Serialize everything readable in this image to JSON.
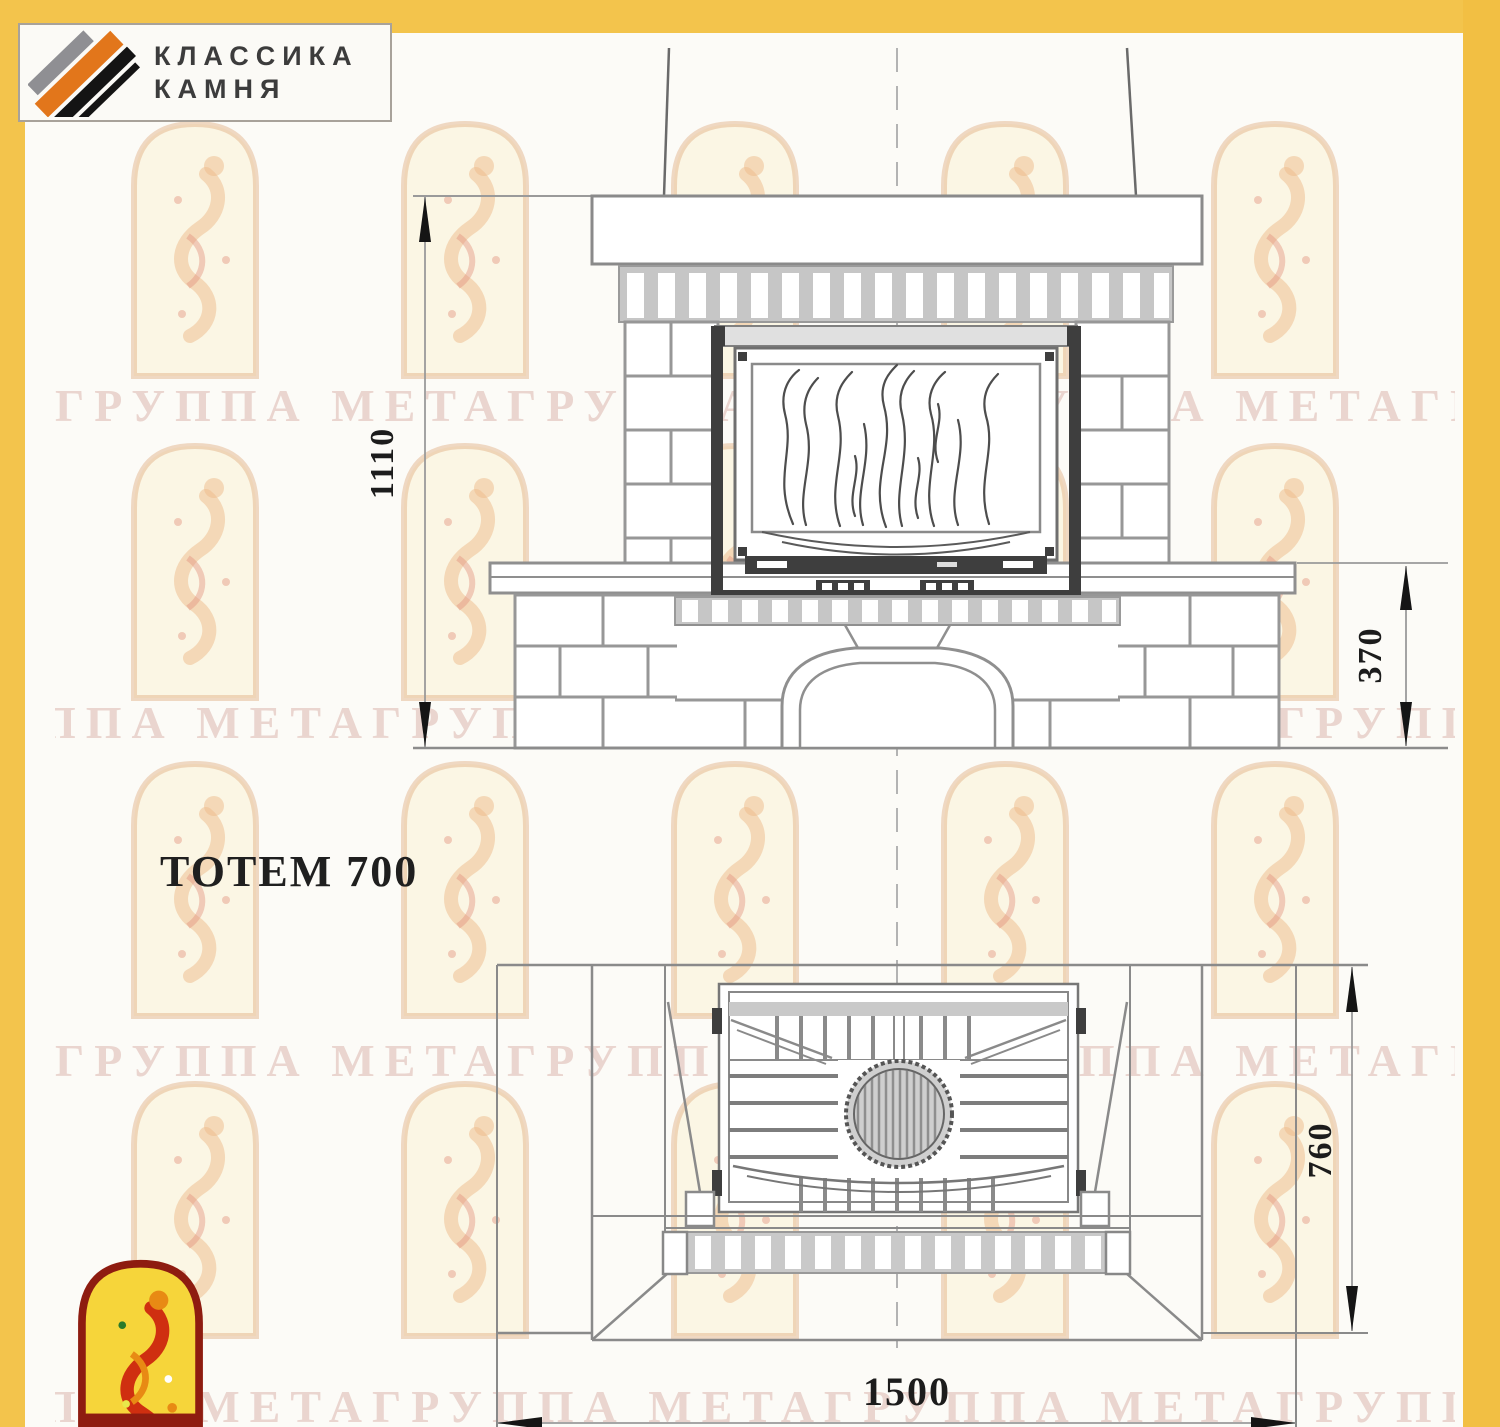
{
  "brand": {
    "line1": "КЛАССИКА",
    "line2": "КАМНЯ"
  },
  "title": "ТОТЕМ 700",
  "dimensions": {
    "front_height": "1110",
    "plinth_height": "370",
    "depth": "760",
    "width": "1500"
  },
  "watermark": {
    "text": "ГРУППА МЕТАГРУППА МЕТАГРУППА МЕТАГРУППА"
  },
  "colors": {
    "page_band": "#f3c44c",
    "logo_orange": "#e2761b",
    "logo_gray": "#8f8f93",
    "logo_black": "#141414",
    "arch_border_red": "#8e1c10",
    "arch_yellow": "#f6d53a",
    "figure_red": "#cf2f10",
    "figure_orange": "#e88a14",
    "line_gray": "#8d8d8d",
    "firebox_dark": "#3e3e3e"
  }
}
